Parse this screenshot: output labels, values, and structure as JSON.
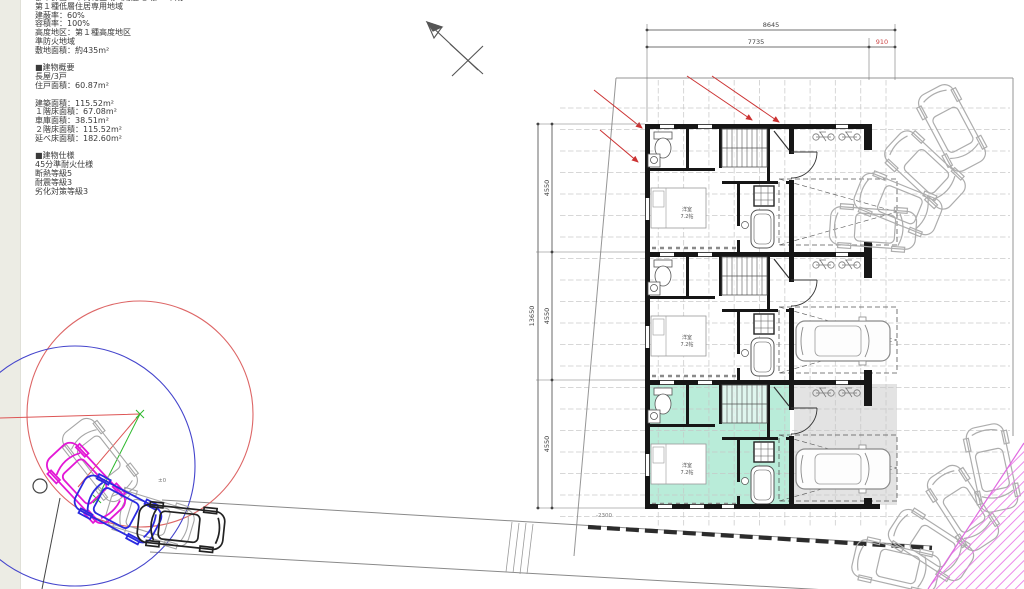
{
  "info_panel": {
    "clipped_line": "都市計画：市街化区域（用途地域）　平成",
    "lines": [
      "第１種低層住居専用地域",
      "建蔽率：60%",
      "容積率：100%",
      "高度地区：第１種高度地区",
      "準防火地域",
      "敷地面積：約435m²",
      "",
      "■建物概要",
      "長屋/3戸",
      "住戸面積：60.87m²",
      "",
      "建築面積：115.52m²",
      "１階床面積：67.08m²",
      "車庫面積：38.51m²",
      "２階床面積：115.52m²",
      "延べ床面積：182.60m²",
      "",
      "■建物仕様",
      "45分準耐火仕様",
      "断熱等級5",
      "耐震等級3",
      "劣化対策等級3"
    ]
  },
  "dimensions": {
    "top_total": "8645",
    "top_main": "7735",
    "top_sub": "910",
    "left_total": "13650",
    "seg1": "4550",
    "seg2": "4550",
    "seg3": "4550",
    "level_note": "-2300",
    "ground_level": "±0"
  },
  "plan": {
    "room_label": "洋室",
    "room_size": "7.2帖",
    "units": 3
  },
  "colors": {
    "dimension_accent": "#cc4444",
    "red_guide": "#cc3333",
    "turn_circle_red": "#dd6666",
    "turn_circle_blue": "#4444cc",
    "car_magenta": "#e318d6",
    "car_blue": "#2a2ae0",
    "highlight_green": "#b9ecd9",
    "garage_gray": "#e3e3e3",
    "hatch_magenta": "#ea7ae8"
  }
}
